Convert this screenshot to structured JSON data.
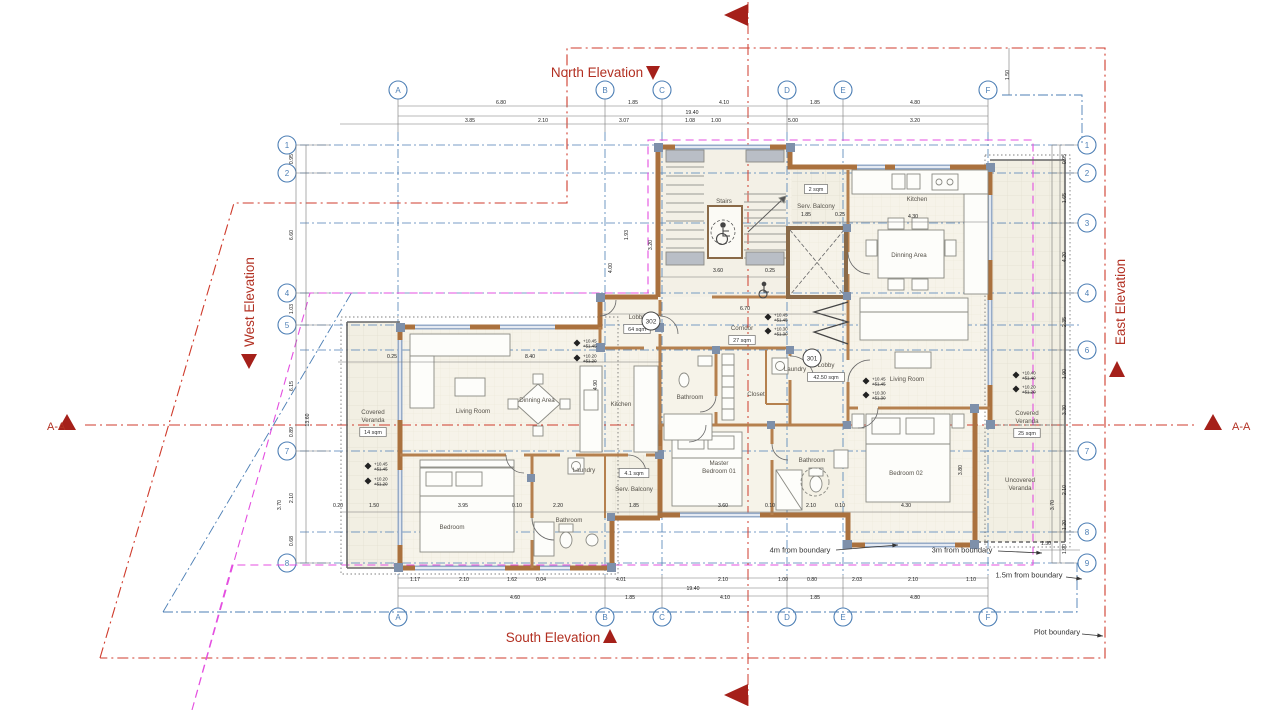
{
  "drawing_type": "floor-plan",
  "elevations": {
    "north": "North Elevation",
    "south": "South Elevation",
    "east": "East Elevation",
    "west": "West Elevation"
  },
  "section_label": "A-A",
  "colors": {
    "grid_blue": "#4d7fb5",
    "plot_boundary_red": "#cf3b2c",
    "setback_magenta": "#e44fe0",
    "wall_tan": "#aa713e",
    "window_blue": "#96abc8",
    "elevation_label_red": "#b23022"
  },
  "grid": {
    "columns": [
      {
        "label": "A",
        "x": 398
      },
      {
        "label": "B",
        "x": 605
      },
      {
        "label": "C",
        "x": 662
      },
      {
        "label": "D",
        "x": 787
      },
      {
        "label": "E",
        "x": 843
      },
      {
        "label": "F",
        "x": 988
      }
    ],
    "rows_left": [
      {
        "label": "1",
        "y": 145
      },
      {
        "label": "2",
        "y": 173
      },
      {
        "label": "4",
        "y": 293
      },
      {
        "label": "5",
        "y": 325
      },
      {
        "label": "7",
        "y": 451
      },
      {
        "label": "8",
        "y": 563
      }
    ],
    "rows_right": [
      {
        "label": "1",
        "y": 145
      },
      {
        "label": "2",
        "y": 173
      },
      {
        "label": "3",
        "y": 223
      },
      {
        "label": "4",
        "y": 293
      },
      {
        "label": "6",
        "y": 350
      },
      {
        "label": "7",
        "y": 451
      },
      {
        "label": "8",
        "y": 532
      },
      {
        "label": "9",
        "y": 563
      }
    ]
  },
  "unit_tags": [
    {
      "label": "302",
      "x": 651,
      "y": 321
    },
    {
      "label": "301",
      "x": 812,
      "y": 358
    }
  ],
  "rooms": [
    {
      "label": "Stairs",
      "x": 724,
      "y": 203
    },
    {
      "label": "Lobby",
      "tag": "64 sqm",
      "x": 637,
      "y": 319
    },
    {
      "label": "Corridor",
      "tag": "27 sqm",
      "x": 742,
      "y": 330
    },
    {
      "label": "Lobby",
      "tag": "42.50 sqm",
      "x": 826,
      "y": 367
    },
    {
      "label": "Serv. Balcony",
      "tag": "2 sqm",
      "x": 816,
      "y": 208,
      "tag_dy": -29
    },
    {
      "label": "Kitchen",
      "x": 917,
      "y": 201
    },
    {
      "label": "Dinning Area",
      "x": 909,
      "y": 257
    },
    {
      "label": "Living Room",
      "x": 907,
      "y": 381
    },
    {
      "label": "Covered",
      "label2": "Veranda",
      "tag": "25 sqm",
      "x": 1027,
      "y": 415
    },
    {
      "label": "Uncovered",
      "label2": "Veranda",
      "x": 1020,
      "y": 482
    },
    {
      "label": "Bedroom 02",
      "x": 906,
      "y": 475
    },
    {
      "label": "Bathroom",
      "x": 812,
      "y": 462
    },
    {
      "label": "Laundry",
      "x": 795,
      "y": 371
    },
    {
      "label": "Closet",
      "x": 756,
      "y": 396
    },
    {
      "label": "Master",
      "label2": "Bedroom 01",
      "x": 719,
      "y": 465
    },
    {
      "label": "Bathroom",
      "x": 690,
      "y": 399
    },
    {
      "label": "Kitchen",
      "x": 621,
      "y": 406
    },
    {
      "label": "Laundry",
      "x": 584,
      "y": 472
    },
    {
      "label": "Serv. Balcony",
      "tag": "4.1 sqm",
      "x": 634,
      "y": 491,
      "tag_dy": -28
    },
    {
      "label": "Bathroom",
      "x": 569,
      "y": 522
    },
    {
      "label": "Bedroom",
      "x": 452,
      "y": 529
    },
    {
      "label": "Dinning Area",
      "x": 537,
      "y": 402
    },
    {
      "label": "Living Room",
      "x": 473,
      "y": 413
    },
    {
      "label": "Covered",
      "label2": "Veranda",
      "tag": "14 sqm",
      "x": 373,
      "y": 414
    }
  ],
  "levels": [
    {
      "x": 368,
      "y": 466,
      "a": "+10.45",
      "b": "+51.45"
    },
    {
      "x": 368,
      "y": 481,
      "a": "+10.20",
      "b": "+51.20"
    },
    {
      "x": 577,
      "y": 343,
      "a": "+10.45",
      "b": "+51.45"
    },
    {
      "x": 577,
      "y": 358,
      "a": "+10.20",
      "b": "+51.20"
    },
    {
      "x": 768,
      "y": 317,
      "a": "+10.45",
      "b": "+51.45"
    },
    {
      "x": 768,
      "y": 331,
      "a": "+10.30",
      "b": "+51.30"
    },
    {
      "x": 866,
      "y": 381,
      "a": "+10.45",
      "b": "+51.45"
    },
    {
      "x": 866,
      "y": 395,
      "a": "+10.30",
      "b": "+51.30"
    },
    {
      "x": 1016,
      "y": 375,
      "a": "+10.40",
      "b": "+51.40"
    },
    {
      "x": 1016,
      "y": 389,
      "a": "+10.20",
      "b": "+51.20"
    }
  ],
  "annotations": [
    {
      "label": "4m from boundary",
      "x": 800,
      "y": 550,
      "ax": 836,
      "ay": 550,
      "bx": 898,
      "by": 545
    },
    {
      "label": "3m from boundary",
      "x": 962,
      "y": 550,
      "ax": 998,
      "ay": 551,
      "bx": 1042,
      "by": 553
    },
    {
      "label": "1.5m from boundary",
      "x": 1029,
      "y": 575,
      "ax": 1066,
      "ay": 577,
      "bx": 1082,
      "by": 579
    },
    {
      "label": "Plot boundary",
      "x": 1057,
      "y": 632,
      "ax": 1082,
      "ay": 634,
      "bx": 1103,
      "by": 636
    }
  ],
  "dims": [
    {
      "v": "6.80",
      "x": 501,
      "y": 104
    },
    {
      "v": "1.85",
      "x": 633,
      "y": 104
    },
    {
      "v": "4.10",
      "x": 724,
      "y": 104
    },
    {
      "v": "1.85",
      "x": 815,
      "y": 104
    },
    {
      "v": "4.80",
      "x": 915,
      "y": 104
    },
    {
      "v": "19.40",
      "x": 692,
      "y": 114
    },
    {
      "v": "3.85",
      "x": 470,
      "y": 122
    },
    {
      "v": "2.10",
      "x": 543,
      "y": 122
    },
    {
      "v": "3.07",
      "x": 624,
      "y": 122
    },
    {
      "v": "1.08",
      "x": 690,
      "y": 122
    },
    {
      "v": "1.00",
      "x": 716,
      "y": 122
    },
    {
      "v": "5.00",
      "x": 793,
      "y": 122
    },
    {
      "v": "3.20",
      "x": 915,
      "y": 122
    },
    {
      "v": "1.17",
      "x": 415,
      "y": 581
    },
    {
      "v": "2.10",
      "x": 464,
      "y": 581
    },
    {
      "v": "1.62",
      "x": 512,
      "y": 581
    },
    {
      "v": "0.04",
      "x": 541,
      "y": 581
    },
    {
      "v": "4.01",
      "x": 621,
      "y": 581
    },
    {
      "v": "2.10",
      "x": 723,
      "y": 581
    },
    {
      "v": "1.00",
      "x": 783,
      "y": 581
    },
    {
      "v": "0.80",
      "x": 812,
      "y": 581
    },
    {
      "v": "2.03",
      "x": 857,
      "y": 581
    },
    {
      "v": "2.10",
      "x": 913,
      "y": 581
    },
    {
      "v": "1.10",
      "x": 971,
      "y": 581
    },
    {
      "v": "19.40",
      "x": 693,
      "y": 590
    },
    {
      "v": "4.60",
      "x": 515,
      "y": 599
    },
    {
      "v": "1.85",
      "x": 630,
      "y": 599
    },
    {
      "v": "4.10",
      "x": 725,
      "y": 599
    },
    {
      "v": "1.85",
      "x": 815,
      "y": 599
    },
    {
      "v": "4.80",
      "x": 915,
      "y": 599
    },
    {
      "v": "0.95",
      "x": 293,
      "y": 159,
      "r": 1
    },
    {
      "v": "6.60",
      "x": 293,
      "y": 235,
      "r": 1
    },
    {
      "v": "1.03",
      "x": 293,
      "y": 309,
      "r": 1
    },
    {
      "v": "6.15",
      "x": 293,
      "y": 386,
      "r": 1
    },
    {
      "v": "13.60",
      "x": 309,
      "y": 420,
      "r": 1
    },
    {
      "v": "0.89",
      "x": 293,
      "y": 432,
      "r": 1
    },
    {
      "v": "2.10",
      "x": 293,
      "y": 498,
      "r": 1
    },
    {
      "v": "3.70",
      "x": 281,
      "y": 505,
      "r": 1
    },
    {
      "v": "0.68",
      "x": 293,
      "y": 541,
      "r": 1
    },
    {
      "v": "0.95",
      "x": 1066,
      "y": 159,
      "r": 1
    },
    {
      "v": "1.65",
      "x": 1066,
      "y": 198,
      "r": 1
    },
    {
      "v": "4.20",
      "x": 1066,
      "y": 257,
      "r": 1
    },
    {
      "v": "2.35",
      "x": 1066,
      "y": 322,
      "r": 1
    },
    {
      "v": "1.90",
      "x": 1066,
      "y": 374,
      "r": 1
    },
    {
      "v": "3.30",
      "x": 1066,
      "y": 410,
      "r": 1
    },
    {
      "v": "2.10",
      "x": 1066,
      "y": 490,
      "r": 1
    },
    {
      "v": "3.70",
      "x": 1054,
      "y": 505,
      "r": 1
    },
    {
      "v": "1.20",
      "x": 1066,
      "y": 525,
      "r": 1
    },
    {
      "v": "1.90",
      "x": 1066,
      "y": 549,
      "r": 1
    },
    {
      "v": "1.50",
      "x": 1046,
      "y": 545
    },
    {
      "v": "1.50",
      "x": 1009,
      "y": 75,
      "r": 1
    },
    {
      "v": "1.93",
      "x": 628,
      "y": 235,
      "r": 1
    },
    {
      "v": "3.20",
      "x": 652,
      "y": 245,
      "r": 1
    },
    {
      "v": "4.00",
      "x": 612,
      "y": 268,
      "r": 1
    },
    {
      "v": "8.40",
      "x": 530,
      "y": 358
    },
    {
      "v": "0.25",
      "x": 392,
      "y": 358
    },
    {
      "v": "3.60",
      "x": 718,
      "y": 272
    },
    {
      "v": "0.25",
      "x": 770,
      "y": 272
    },
    {
      "v": "1.85",
      "x": 806,
      "y": 216
    },
    {
      "v": "0.25",
      "x": 840,
      "y": 216
    },
    {
      "v": "4.30",
      "x": 913,
      "y": 218
    },
    {
      "v": "6.70",
      "x": 745,
      "y": 310
    },
    {
      "v": "1.85",
      "x": 634,
      "y": 507
    },
    {
      "v": "3.60",
      "x": 723,
      "y": 507
    },
    {
      "v": "0.10",
      "x": 770,
      "y": 507
    },
    {
      "v": "2.10",
      "x": 811,
      "y": 507
    },
    {
      "v": "0.10",
      "x": 840,
      "y": 507
    },
    {
      "v": "4.30",
      "x": 906,
      "y": 507
    },
    {
      "v": "1.50",
      "x": 374,
      "y": 507
    },
    {
      "v": "3.95",
      "x": 463,
      "y": 507
    },
    {
      "v": "0.10",
      "x": 517,
      "y": 507
    },
    {
      "v": "2.20",
      "x": 558,
      "y": 507
    },
    {
      "v": "0.20",
      "x": 338,
      "y": 507
    },
    {
      "v": "4.90",
      "x": 597,
      "y": 385,
      "r": 1
    },
    {
      "v": "3.80",
      "x": 962,
      "y": 470,
      "r": 1
    }
  ]
}
